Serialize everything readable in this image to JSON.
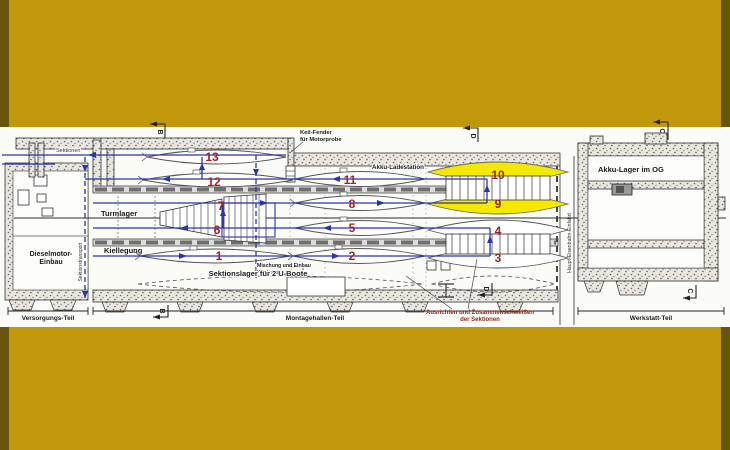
{
  "colors": {
    "background_gold": "#c1980a",
    "background_edge": "#68560c",
    "panel_white": "#fbfbf8",
    "flow_blue": "#2a35a8",
    "station_red": "#9e2424",
    "highlight_yellow": "#f2e800",
    "wall_fill": "#e8e6df"
  },
  "stations": [
    {
      "label": "1"
    },
    {
      "label": "2"
    },
    {
      "label": "3"
    },
    {
      "label": "4"
    },
    {
      "label": "5"
    },
    {
      "label": "6"
    },
    {
      "label": "7"
    },
    {
      "label": "8"
    },
    {
      "label": "9"
    },
    {
      "label": "10"
    },
    {
      "label": "11"
    },
    {
      "label": "12"
    },
    {
      "label": "13"
    }
  ],
  "labels": {
    "sektionen": "Sektionen",
    "keil_fender_line1": "Keil-Fender",
    "keil_fender_line2": "für Motorprobe",
    "akku_ladestation": "Akku-Ladestation",
    "akku_lager_im_og": "Akku-Lager im OG",
    "turmlager": "Turmlager",
    "kiellegung": "Kiellegung",
    "dieselmotor_line1": "Dieselmotor-",
    "dieselmotor_line2": "Einbau",
    "mischung_line1": "Mischung und Einbau",
    "mischung_line2": "Kielballast",
    "sektionslager": "Sektionslager für 2 U-Boote",
    "ausrichten_line1": "Ausrichten und Zusammenschweißen",
    "ausrichten_line2": "der Sektionen",
    "sektionstransport": "Sektionstransport",
    "haupt_eisenbahn_einfahrt": "Haupt-Eisenbahn-Einfahrt"
  },
  "zones": {
    "versorgungs_teil": "Versorgungs-Teil",
    "montagehallen_teil": "Montagehallen-Teil",
    "werkstatt_teil": "Werkstatt-Teil"
  },
  "section_markers": {
    "b": "B",
    "c": "C",
    "d": "D"
  }
}
